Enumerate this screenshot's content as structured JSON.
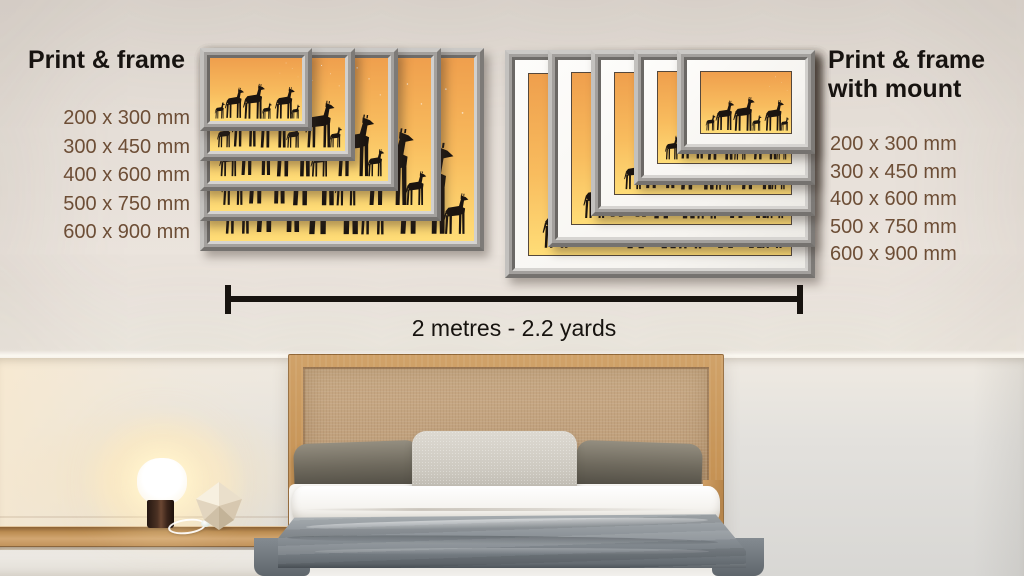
{
  "left_panel": {
    "title": "Print & frame",
    "sizes": [
      "200 x 300 mm",
      "300 x 450 mm",
      "400 x 600 mm",
      "500 x 750 mm",
      "600 x 900 mm"
    ]
  },
  "right_panel": {
    "title_line1": "Print & frame",
    "title_line2": "with mount",
    "sizes": [
      "200 x 300 mm",
      "300 x 450 mm",
      "400 x 600 mm",
      "500 x 750 mm",
      "600 x 900 mm"
    ]
  },
  "scale_bar": {
    "label": "2 metres - 2.2 yards"
  },
  "artwork": {
    "subject": "giraffe-silhouette-print",
    "colors": {
      "sky_top": "#ef9f4d",
      "sky_mid": "#f8bc5e",
      "sky_bottom": "#ffdd77",
      "silhouette": "#1a1410",
      "frame_gray": "#a3a09d",
      "mount_white": "#fdfcfa"
    }
  },
  "text_colors": {
    "heading": "#171310",
    "size_label": "#6d4e36",
    "scale_label": "#17130f"
  }
}
